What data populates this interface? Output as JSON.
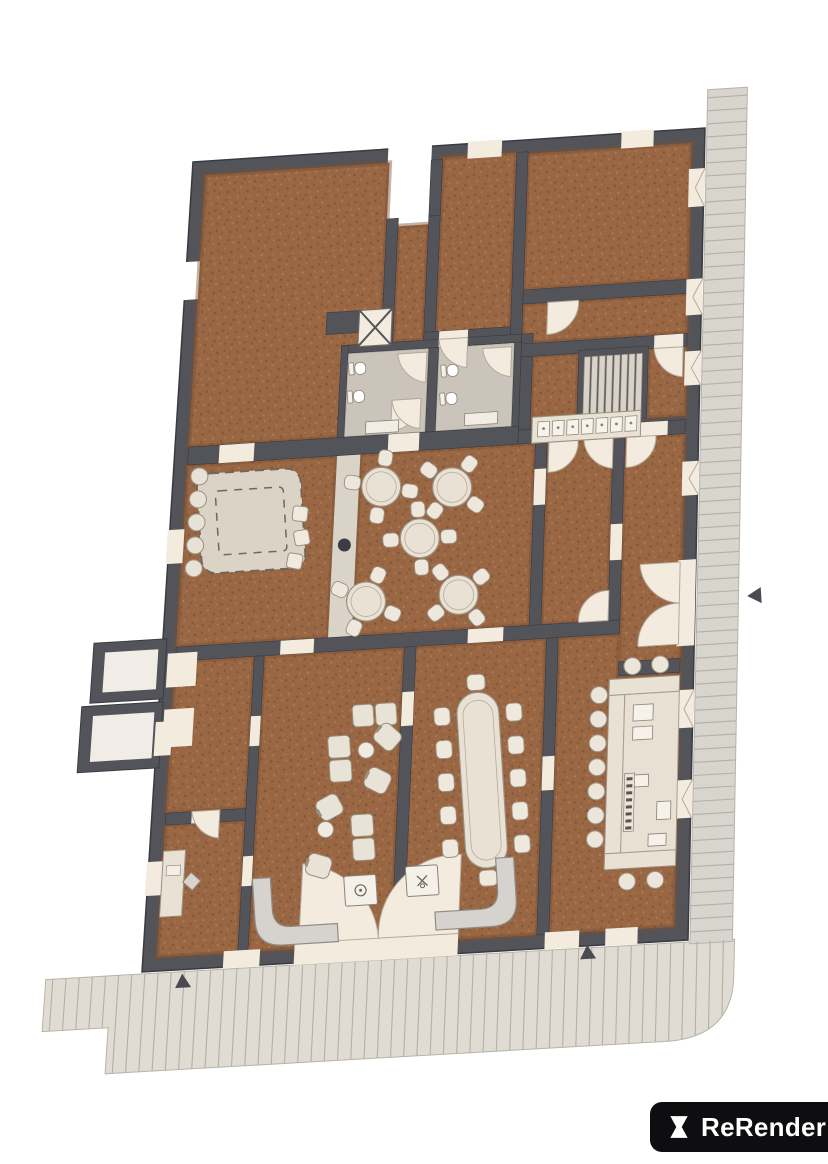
{
  "meta": {
    "title": "Floor plan render",
    "view": "top-down architectural rendering"
  },
  "logo": {
    "label": "ReRender"
  },
  "colors": {
    "bg": "#FFFFFF",
    "wall": "#53535A",
    "wall_dark": "#3A3A41",
    "floor": "#9A6745",
    "floor_dark": "#7A5233",
    "floor_light": "#B67F55",
    "bath_floor": "#CBC4BA",
    "walkway": "#D9D3C8",
    "furniture": "#E9E1D3",
    "furniture_stroke": "#9A9183",
    "sofa": "#D6D3CE",
    "sofa_stroke": "#8F8C86",
    "door": "#F2EBDE",
    "door_stroke": "#B3AA9B",
    "sidewalk": "#E0DCD4",
    "sidewalk_line": "#B5AFA5",
    "sidewalk_right": "#D8D5CF",
    "rug": "#DBD4C6",
    "rug_stroke": "#6E675B",
    "stairs": "#D8D2C8",
    "stairs_stroke": "#8B8478",
    "marker": "#4A4A50",
    "logo_bg": "#0E0E10",
    "logo_text": "#FFFFFF"
  },
  "plan": {
    "rooms": [
      {
        "id": "hall-top-left",
        "label": "Main hall"
      },
      {
        "id": "room-top-center",
        "label": "Meeting room"
      },
      {
        "id": "room-top-right",
        "label": "Upper room"
      },
      {
        "id": "corridor-upper",
        "label": "Corridor"
      },
      {
        "id": "staircase",
        "label": "Staircase"
      },
      {
        "id": "kitchenette",
        "label": "Kitchenette counter"
      },
      {
        "id": "restroom-left",
        "label": "Restroom"
      },
      {
        "id": "restroom-right",
        "label": "Restroom"
      },
      {
        "id": "lounge-rug-room",
        "label": "Rug lounge"
      },
      {
        "id": "cafe-seating",
        "label": "Cafe seating"
      },
      {
        "id": "hallway-mid",
        "label": "Hallway"
      },
      {
        "id": "entry-vestibule",
        "label": "Entry vestibule"
      },
      {
        "id": "side-room",
        "label": "Side room"
      },
      {
        "id": "office",
        "label": "Office"
      },
      {
        "id": "lounge-seating",
        "label": "Lounge"
      },
      {
        "id": "waiting-area",
        "label": "Waiting area"
      },
      {
        "id": "dining-room",
        "label": "Dining room"
      },
      {
        "id": "bar-room",
        "label": "Bar room"
      }
    ],
    "counts": {
      "cafe_tables": 5,
      "cafe_chairs_per_table": 4,
      "dining_seats": 12,
      "bar_stools": 11,
      "rug_stools": 5,
      "stair_treads": 8,
      "lounge_pieces": 9,
      "restroom_toilets": 4,
      "entrance_markers": 3
    }
  }
}
